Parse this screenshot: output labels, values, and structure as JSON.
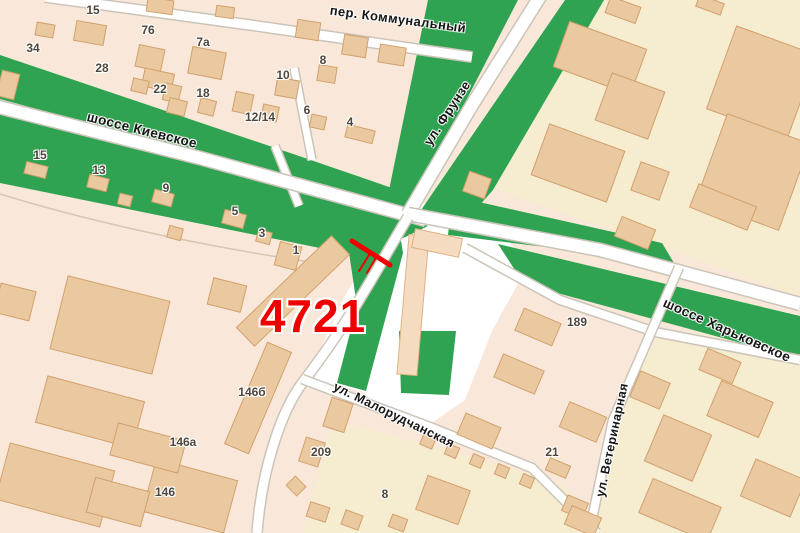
{
  "map": {
    "streets": {
      "kommunalny": "пер. Коммунальный",
      "kievskoe": "шоссе Киевское",
      "frunze": "ул. Фрунзе",
      "kharkovskoe": "шоссе Харьковское",
      "malorudchanskaya": "ул. Малорудчанская",
      "veterinarnaya": "ул. Ветеринарная"
    },
    "marker": {
      "label": "4721"
    },
    "house_numbers": [
      {
        "t": "15",
        "x": 93,
        "y": 10
      },
      {
        "t": "34",
        "x": 33,
        "y": 48
      },
      {
        "t": "76",
        "x": 148,
        "y": 30
      },
      {
        "t": "7а",
        "x": 203,
        "y": 42
      },
      {
        "t": "28",
        "x": 102,
        "y": 68
      },
      {
        "t": "22",
        "x": 160,
        "y": 89
      },
      {
        "t": "18",
        "x": 203,
        "y": 93
      },
      {
        "t": "8",
        "x": 323,
        "y": 60
      },
      {
        "t": "10",
        "x": 283,
        "y": 75
      },
      {
        "t": "12/14",
        "x": 260,
        "y": 117
      },
      {
        "t": "6",
        "x": 307,
        "y": 110
      },
      {
        "t": "4",
        "x": 350,
        "y": 122
      },
      {
        "t": "15",
        "x": 40,
        "y": 155
      },
      {
        "t": "13",
        "x": 99,
        "y": 170
      },
      {
        "t": "9",
        "x": 166,
        "y": 188
      },
      {
        "t": "5",
        "x": 235,
        "y": 211
      },
      {
        "t": "3",
        "x": 262,
        "y": 233
      },
      {
        "t": "1",
        "x": 296,
        "y": 250
      },
      {
        "t": "189",
        "x": 577,
        "y": 322
      },
      {
        "t": "146б",
        "x": 252,
        "y": 392
      },
      {
        "t": "146а",
        "x": 183,
        "y": 442
      },
      {
        "t": "146",
        "x": 165,
        "y": 492
      },
      {
        "t": "209",
        "x": 321,
        "y": 452
      },
      {
        "t": "8",
        "x": 385,
        "y": 494
      },
      {
        "t": "21",
        "x": 552,
        "y": 452
      }
    ],
    "buildings": [
      [
        160,
        6,
        26,
        14,
        8
      ],
      [
        225,
        12,
        18,
        11,
        8
      ],
      [
        90,
        33,
        30,
        20,
        10
      ],
      [
        45,
        30,
        18,
        13,
        10
      ],
      [
        8,
        85,
        18,
        26,
        14
      ],
      [
        150,
        58,
        26,
        22,
        12
      ],
      [
        158,
        80,
        30,
        18,
        12
      ],
      [
        207,
        63,
        34,
        27,
        11
      ],
      [
        308,
        30,
        23,
        18,
        9
      ],
      [
        355,
        46,
        24,
        20,
        9
      ],
      [
        392,
        55,
        26,
        18,
        9
      ],
      [
        140,
        86,
        16,
        13,
        13
      ],
      [
        172,
        93,
        16,
        17,
        13
      ],
      [
        177,
        107,
        18,
        15,
        14
      ],
      [
        207,
        107,
        16,
        15,
        14
      ],
      [
        243,
        103,
        18,
        20,
        12
      ],
      [
        270,
        113,
        16,
        15,
        12
      ],
      [
        287,
        88,
        22,
        18,
        10
      ],
      [
        327,
        74,
        18,
        16,
        9
      ],
      [
        318,
        122,
        15,
        13,
        12
      ],
      [
        360,
        134,
        28,
        13,
        14
      ],
      [
        36,
        170,
        22,
        12,
        14
      ],
      [
        98,
        183,
        20,
        13,
        14
      ],
      [
        163,
        198,
        20,
        13,
        15
      ],
      [
        234,
        219,
        22,
        14,
        15
      ],
      [
        264,
        237,
        14,
        12,
        15
      ],
      [
        288,
        256,
        22,
        24,
        15
      ],
      [
        125,
        200,
        13,
        11,
        14
      ],
      [
        175,
        233,
        14,
        12,
        15
      ],
      [
        110,
        325,
        105,
        75,
        14
      ],
      [
        15,
        302,
        36,
        30,
        14
      ],
      [
        90,
        412,
        100,
        48,
        15
      ],
      [
        55,
        485,
        108,
        58,
        15
      ],
      [
        190,
        496,
        84,
        54,
        15
      ],
      [
        293,
        291,
        132,
        26,
        -44
      ],
      [
        227,
        295,
        34,
        27,
        14
      ],
      [
        258,
        398,
        110,
        26,
        -67
      ],
      [
        148,
        448,
        70,
        33,
        15
      ],
      [
        118,
        502,
        56,
        36,
        15
      ],
      [
        338,
        415,
        22,
        30,
        18
      ],
      [
        312,
        452,
        20,
        25,
        18
      ],
      [
        296,
        486,
        15,
        13,
        45
      ],
      [
        318,
        512,
        20,
        15,
        18
      ],
      [
        352,
        520,
        18,
        15,
        20
      ],
      [
        398,
        523,
        16,
        13,
        20
      ],
      [
        413,
        305,
        20,
        140,
        5,
        1
      ],
      [
        437,
        243,
        48,
        19,
        12,
        1
      ],
      [
        538,
        327,
        40,
        24,
        23
      ],
      [
        519,
        374,
        44,
        25,
        23
      ],
      [
        583,
        422,
        40,
        27,
        23
      ],
      [
        479,
        431,
        38,
        23,
        23
      ],
      [
        428,
        441,
        13,
        12,
        23
      ],
      [
        452,
        451,
        12,
        11,
        23
      ],
      [
        477,
        461,
        12,
        11,
        23
      ],
      [
        502,
        471,
        12,
        11,
        23
      ],
      [
        527,
        481,
        12,
        11,
        23
      ],
      [
        558,
        468,
        22,
        13,
        23
      ],
      [
        623,
        10,
        32,
        17,
        20
      ],
      [
        710,
        5,
        26,
        12,
        20
      ],
      [
        600,
        58,
        82,
        48,
        20
      ],
      [
        630,
        106,
        56,
        50,
        20
      ],
      [
        762,
        82,
        86,
        88,
        20
      ],
      [
        578,
        163,
        80,
        54,
        20
      ],
      [
        650,
        181,
        30,
        30,
        20
      ],
      [
        753,
        172,
        88,
        92,
        20
      ],
      [
        635,
        233,
        36,
        21,
        22
      ],
      [
        723,
        207,
        62,
        25,
        22
      ],
      [
        477,
        185,
        23,
        21,
        20
      ],
      [
        720,
        366,
        36,
        23,
        23
      ],
      [
        650,
        390,
        32,
        28,
        23
      ],
      [
        740,
        409,
        56,
        38,
        23
      ],
      [
        678,
        448,
        52,
        50,
        23
      ],
      [
        680,
        510,
        74,
        37,
        23
      ],
      [
        773,
        488,
        54,
        40,
        23
      ],
      [
        443,
        500,
        45,
        36,
        20
      ],
      [
        575,
        507,
        22,
        17,
        23
      ],
      [
        583,
        521,
        32,
        20,
        23
      ]
    ],
    "colors": {
      "green": "#2fa351",
      "land": "#f9e8d9",
      "cream": "#f6ecd0",
      "bld": "#eac9a0",
      "bld-stroke": "#d2a06c",
      "bld-light": "#f5dcc1",
      "road": "#ffffff",
      "casing": "#cbc4b9",
      "red": "#ee0000"
    }
  }
}
